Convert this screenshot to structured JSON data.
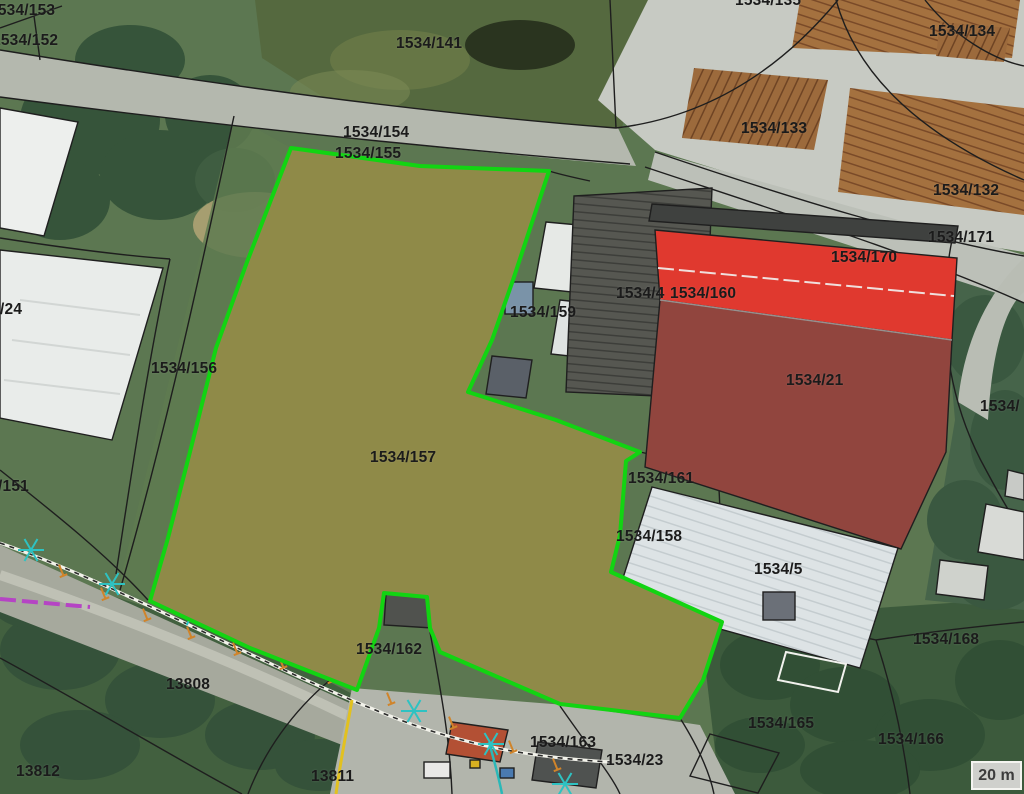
{
  "map": {
    "title": "cadastral-aerial-view",
    "scale_label": "20 m",
    "colors": {
      "highlight_boundary": "#12d412",
      "red_building": "#e0392f",
      "red_building_dark": "#91453e",
      "label": "#1b1b1b",
      "tree_symbol": "#2ec2c2",
      "marker_tick": "#d0842a",
      "utility_line_yellow": "#e2c11f",
      "utility_line_purple": "#b544c4",
      "utility_line_teal": "#2ab8b8",
      "scalebar_bg": "#cfd0cc",
      "scalebar_text": "#3c3c3c"
    },
    "parcel_labels": [
      {
        "text": "1534/153",
        "x": -11,
        "y": 3
      },
      {
        "text": "1534/152",
        "x": -8,
        "y": 33
      },
      {
        "text": "1534/141",
        "x": 396,
        "y": 36
      },
      {
        "text": "1534/154",
        "x": 343,
        "y": 125
      },
      {
        "text": "1534/155",
        "x": 335,
        "y": 146
      },
      {
        "text": "1534/135",
        "x": 735,
        "y": -7
      },
      {
        "text": "1534/134",
        "x": 929,
        "y": 24
      },
      {
        "text": "1534/133",
        "x": 741,
        "y": 121
      },
      {
        "text": "1534/132",
        "x": 933,
        "y": 183
      },
      {
        "text": "1534/171",
        "x": 928,
        "y": 230
      },
      {
        "text": "1534/170",
        "x": 831,
        "y": 250
      },
      {
        "text": "1534/159",
        "x": 510,
        "y": 305
      },
      {
        "text": "1534/4",
        "x": 616,
        "y": 286
      },
      {
        "text": "1534/160",
        "x": 670,
        "y": 286
      },
      {
        "text": "1534/21",
        "x": 786,
        "y": 373
      },
      {
        "text": "1534/156",
        "x": 151,
        "y": 361
      },
      {
        "text": "/24",
        "x": 0,
        "y": 302
      },
      {
        "text": "/151",
        "x": -2,
        "y": 479
      },
      {
        "text": "1534/157",
        "x": 370,
        "y": 450
      },
      {
        "text": "1534/161",
        "x": 628,
        "y": 471
      },
      {
        "text": "1534/158",
        "x": 616,
        "y": 529
      },
      {
        "text": "1534/5",
        "x": 754,
        "y": 562
      },
      {
        "text": "1534/168",
        "x": 913,
        "y": 632
      },
      {
        "text": "1534/165",
        "x": 748,
        "y": 716
      },
      {
        "text": "1534/166",
        "x": 878,
        "y": 732
      },
      {
        "text": "1534/162",
        "x": 356,
        "y": 642
      },
      {
        "text": "1534/163",
        "x": 530,
        "y": 735
      },
      {
        "text": "1534/23",
        "x": 606,
        "y": 753
      },
      {
        "text": "13808",
        "x": 166,
        "y": 677
      },
      {
        "text": "13812",
        "x": 16,
        "y": 764
      },
      {
        "text": "13811",
        "x": 311,
        "y": 769
      },
      {
        "text": "1534/",
        "x": 980,
        "y": 399
      }
    ],
    "tree_markers": [
      [
        31,
        550
      ],
      [
        112,
        584
      ],
      [
        193,
        614
      ],
      [
        327,
        589
      ],
      [
        575,
        616
      ],
      [
        414,
        711
      ],
      [
        491,
        744
      ],
      [
        565,
        784
      ]
    ],
    "boundary_ticks": [
      [
        62,
        572
      ],
      [
        104,
        595
      ],
      [
        146,
        616
      ],
      [
        190,
        634
      ],
      [
        236,
        650
      ],
      [
        282,
        664
      ],
      [
        330,
        678
      ],
      [
        390,
        700
      ],
      [
        452,
        724
      ],
      [
        512,
        748
      ],
      [
        556,
        766
      ]
    ]
  }
}
